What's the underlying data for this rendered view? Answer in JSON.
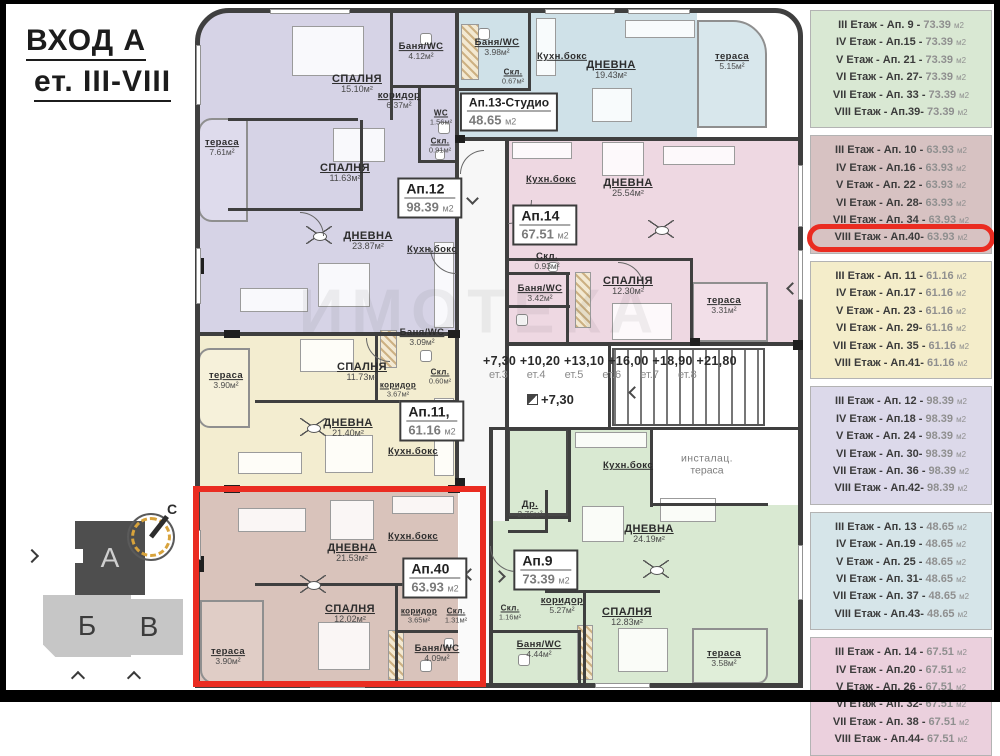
{
  "page": {
    "title_line1": "ВХОД А",
    "title_line2": "ет. III-VIII"
  },
  "legend": {
    "unit": "м2",
    "groups": [
      {
        "color": "#d9e8d3",
        "rows": [
          {
            "label": "III Етаж - Ап. 9 -",
            "area": "73.39"
          },
          {
            "label": "IV Етаж - Ап.15 -",
            "area": "73.39"
          },
          {
            "label": "V Етаж - Ап. 21 -",
            "area": "73.39"
          },
          {
            "label": "VI Етаж - Ап. 27-",
            "area": "73.39"
          },
          {
            "label": "VII Етаж - Ап. 33 -",
            "area": "73.39"
          },
          {
            "label": "VIII Етаж - Ап.39-",
            "area": "73.39"
          }
        ]
      },
      {
        "color": "#d7c2c2",
        "rows": [
          {
            "label": "III Етаж - Ап. 10 -",
            "area": "63.93"
          },
          {
            "label": "IV Етаж - Ап.16 -",
            "area": "63.93"
          },
          {
            "label": "V Етаж - Ап. 22 -",
            "area": "63.93"
          },
          {
            "label": "VI Етаж - Ап. 28-",
            "area": "63.93"
          },
          {
            "label": "VII Етаж - Ап. 34 -",
            "area": "63.93"
          },
          {
            "label": "VIII Етаж - Ап.40-",
            "area": "63.93",
            "highlight": true
          }
        ]
      },
      {
        "color": "#f4edca",
        "rows": [
          {
            "label": "III Етаж - Ап. 11 -",
            "area": "61.16"
          },
          {
            "label": "IV Етаж - Ап.17 -",
            "area": "61.16"
          },
          {
            "label": "V Етаж - Ап. 23 -",
            "area": "61.16"
          },
          {
            "label": "VI Етаж - Ап. 29-",
            "area": "61.16"
          },
          {
            "label": "VII Етаж - Ап. 35 -",
            "area": "61.16"
          },
          {
            "label": "VIII Етаж - Ап.41-",
            "area": "61.16"
          }
        ]
      },
      {
        "color": "#dcd9ea",
        "rows": [
          {
            "label": "III Етаж - Ап. 12 -",
            "area": "98.39"
          },
          {
            "label": "IV Етаж - Ап.18 -",
            "area": "98.39"
          },
          {
            "label": "V Етаж - Ап. 24 -",
            "area": "98.39"
          },
          {
            "label": "VI Етаж - Ап. 30-",
            "area": "98.39"
          },
          {
            "label": "VII Етаж - Ап. 36 -",
            "area": "98.39"
          },
          {
            "label": "VIII Етаж - Ап.42-",
            "area": "98.39"
          }
        ]
      },
      {
        "color": "#d6e5e9",
        "rows": [
          {
            "label": "III Етаж - Ап. 13 -",
            "area": "48.65"
          },
          {
            "label": "IV Етаж - Ап.19 -",
            "area": "48.65"
          },
          {
            "label": "V Етаж - Ап. 25 -",
            "area": "48.65"
          },
          {
            "label": "VI Етаж - Ап. 31-",
            "area": "48.65"
          },
          {
            "label": "VII Етаж - Ап. 37 -",
            "area": "48.65"
          },
          {
            "label": "VIII Етаж - Ап.43-",
            "area": "48.65"
          }
        ]
      },
      {
        "color": "#ebd0dd",
        "rows": [
          {
            "label": "III Етаж - Ап. 14 -",
            "area": "67.51"
          },
          {
            "label": "IV Етаж - Ап.20 -",
            "area": "67.51"
          },
          {
            "label": "V Етаж - Ап. 26 -",
            "area": "67.51"
          },
          {
            "label": "VI Етаж - Ап. 32-",
            "area": "67.51"
          },
          {
            "label": "VII Етаж - Ап. 38 -",
            "area": "67.51"
          },
          {
            "label": "VIII Етаж - Ап.44-",
            "area": "67.51"
          }
        ]
      }
    ]
  },
  "plan": {
    "watermark": "ИМОТЕКА",
    "palette": {
      "apt12": "#d6d3e6",
      "apt13": "#cfe1e8",
      "apt14": "#eed8e2",
      "apt11": "#f3edd0",
      "apt40": "#d9c3bb",
      "apt9": "#d9e9d2",
      "wall": "#3f3f3f",
      "highlight_red": "#ea2c21"
    },
    "elevations": {
      "list": "+7,30 +10,20 +13,10 +16,00 +18,90 +21,80",
      "floors": "ет.3 ет.4 ет.5 ет.6 ет.7 ет.8",
      "single": "+7,30"
    },
    "rooms": [
      {
        "x": 357,
        "y": 84,
        "name": "СПАЛНЯ",
        "area": "15.10м²",
        "s": ""
      },
      {
        "x": 421,
        "y": 52,
        "name": "Баня/WC",
        "area": "4.12м²",
        "s": "sm"
      },
      {
        "x": 399,
        "y": 101,
        "name": "коридор",
        "area": "6.37м²",
        "s": "sm"
      },
      {
        "x": 441,
        "y": 118,
        "name": "WC",
        "area": "1.56м²",
        "s": "xs"
      },
      {
        "x": 440,
        "y": 146,
        "name": "Скл.",
        "area": "0.91м²",
        "s": "xs"
      },
      {
        "x": 222,
        "y": 148,
        "name": "тераса",
        "area": "7.61м²",
        "s": "sm"
      },
      {
        "x": 345,
        "y": 173,
        "name": "СПАЛНЯ",
        "area": "11.63м²",
        "s": ""
      },
      {
        "x": 368,
        "y": 241,
        "name": "ДНЕВНА",
        "area": "23.87м²",
        "s": ""
      },
      {
        "x": 432,
        "y": 250,
        "name": "Кухн.бокс",
        "area": "",
        "s": "sm"
      },
      {
        "x": 497,
        "y": 48,
        "name": "Баня/WC",
        "area": "3.98м²",
        "s": "sm"
      },
      {
        "x": 513,
        "y": 77,
        "name": "Скл.",
        "area": "0.67м²",
        "s": "xs"
      },
      {
        "x": 562,
        "y": 57,
        "name": "Кухн.бокс",
        "area": "",
        "s": "sm"
      },
      {
        "x": 611,
        "y": 70,
        "name": "ДНЕВНА",
        "area": "19.43м²",
        "s": ""
      },
      {
        "x": 732,
        "y": 62,
        "name": "тераса",
        "area": "5.15м²",
        "s": "sm"
      },
      {
        "x": 551,
        "y": 180,
        "name": "Кухн.бокс",
        "area": "",
        "s": "sm"
      },
      {
        "x": 628,
        "y": 188,
        "name": "ДНЕВНА",
        "area": "25.54м²",
        "s": ""
      },
      {
        "x": 547,
        "y": 262,
        "name": "Скл.",
        "area": "0.93м²",
        "s": "sm"
      },
      {
        "x": 540,
        "y": 294,
        "name": "Баня/WC",
        "area": "3.42м²",
        "s": "sm"
      },
      {
        "x": 628,
        "y": 286,
        "name": "СПАЛНЯ",
        "area": "12.30м²",
        "s": ""
      },
      {
        "x": 724,
        "y": 306,
        "name": "тераса",
        "area": "3.31м²",
        "s": "sm"
      },
      {
        "x": 707,
        "y": 465,
        "name": "инсталац.",
        "area": "тераса",
        "s": "muted"
      },
      {
        "x": 628,
        "y": 466,
        "name": "Кухн.бокс",
        "area": "",
        "s": "sm"
      },
      {
        "x": 226,
        "y": 381,
        "name": "тераса",
        "area": "3.90м²",
        "s": "sm"
      },
      {
        "x": 362,
        "y": 372,
        "name": "СПАЛНЯ",
        "area": "11.73м²",
        "s": ""
      },
      {
        "x": 422,
        "y": 338,
        "name": "Баня/WC",
        "area": "3.09м²",
        "s": "sm"
      },
      {
        "x": 398,
        "y": 390,
        "name": "коридор",
        "area": "3.67м²",
        "s": "xs"
      },
      {
        "x": 440,
        "y": 377,
        "name": "Скл.",
        "area": "0.60м²",
        "s": "xs"
      },
      {
        "x": 348,
        "y": 428,
        "name": "ДНЕВНА",
        "area": "21.40м²",
        "s": ""
      },
      {
        "x": 413,
        "y": 452,
        "name": "Кухн.бокс",
        "area": "",
        "s": "sm"
      },
      {
        "x": 352,
        "y": 553,
        "name": "ДНЕВНА",
        "area": "21.53м²",
        "s": ""
      },
      {
        "x": 413,
        "y": 537,
        "name": "Кухн.бокс",
        "area": "",
        "s": "sm"
      },
      {
        "x": 350,
        "y": 614,
        "name": "СПАЛНЯ",
        "area": "12.02м²",
        "s": ""
      },
      {
        "x": 419,
        "y": 616,
        "name": "коридор",
        "area": "3.65м²",
        "s": "xs"
      },
      {
        "x": 456,
        "y": 616,
        "name": "Скл.",
        "area": "1.31м²",
        "s": "xs"
      },
      {
        "x": 437,
        "y": 654,
        "name": "Баня/WC",
        "area": "4.09м²",
        "s": "sm"
      },
      {
        "x": 228,
        "y": 657,
        "name": "тераса",
        "area": "3.90м²",
        "s": "sm"
      },
      {
        "x": 530,
        "y": 510,
        "name": "Др.",
        "area": "2.76м²",
        "s": "sm"
      },
      {
        "x": 649,
        "y": 534,
        "name": "ДНЕВНА",
        "area": "24.19м²",
        "s": ""
      },
      {
        "x": 510,
        "y": 613,
        "name": "Скл.",
        "area": "1.16м²",
        "s": "xs"
      },
      {
        "x": 562,
        "y": 606,
        "name": "коридор",
        "area": "5.27м²",
        "s": "sm"
      },
      {
        "x": 627,
        "y": 617,
        "name": "СПАЛНЯ",
        "area": "12.83м²",
        "s": ""
      },
      {
        "x": 539,
        "y": 650,
        "name": "Баня/WC",
        "area": "4.44м²",
        "s": "sm"
      },
      {
        "x": 724,
        "y": 659,
        "name": "тераса",
        "area": "3.58м²",
        "s": "sm"
      }
    ],
    "badges": [
      {
        "x": 430,
        "y": 198,
        "name": "Ап.12",
        "area": "98.39",
        "s": ""
      },
      {
        "x": 509,
        "y": 112,
        "name": "Ап.13-Студио",
        "area": "48.65",
        "s": "studio"
      },
      {
        "x": 545,
        "y": 225,
        "name": "Ап.14",
        "area": "67.51",
        "s": ""
      },
      {
        "x": 432,
        "y": 421,
        "name": "Ап.11,",
        "area": "61.16",
        "s": ""
      },
      {
        "x": 435,
        "y": 578,
        "name": "Ап.40",
        "area": "63.93",
        "s": ""
      },
      {
        "x": 546,
        "y": 570,
        "name": "Ап.9",
        "area": "73.39",
        "s": ""
      }
    ]
  },
  "siteplan": {
    "block_a": "А",
    "block_b": "Б",
    "block_v": "В",
    "north": "С"
  }
}
